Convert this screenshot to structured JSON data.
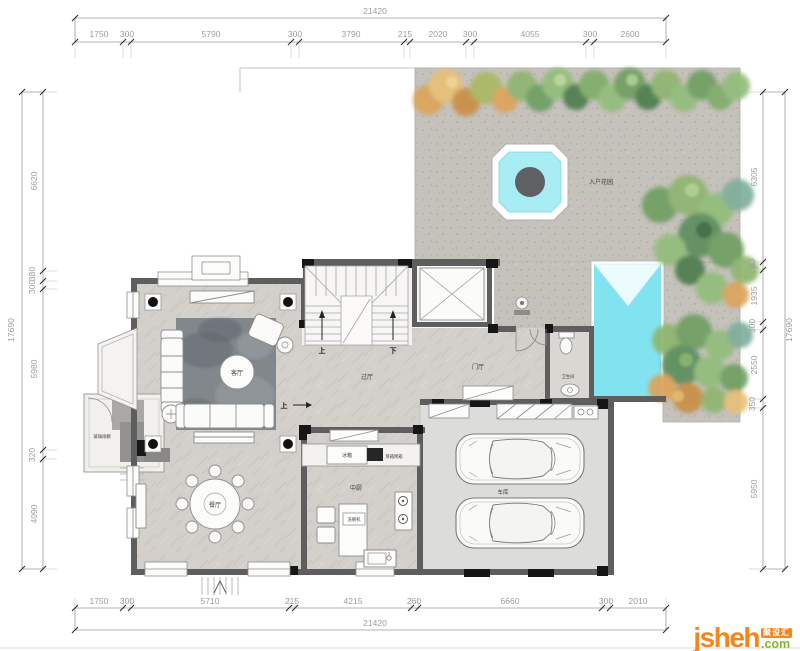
{
  "dims": {
    "top": {
      "total": "21420",
      "segments": [
        "1750",
        "300",
        "5790",
        "300",
        "3790",
        "215",
        "2020",
        "300",
        "4055",
        "300",
        "2600"
      ]
    },
    "bottom": {
      "total": "21420",
      "segments": [
        "1750",
        "300",
        "5710",
        "215",
        "4215",
        "260",
        "6660",
        "300",
        "2010"
      ]
    },
    "left": {
      "total": "17690",
      "segments": [
        "6620",
        "380",
        "300",
        "5980",
        "320",
        "4090"
      ]
    },
    "right": {
      "total": "17690",
      "segments": [
        "6305",
        "300",
        "1935",
        "300",
        "2550",
        "350",
        "5950"
      ]
    }
  },
  "rooms": {
    "garden": "入户花园",
    "living": "客厅",
    "dining": "餐厅",
    "hall": "过厅",
    "foyer": "门厅",
    "kitchen": "中厨",
    "garage": "车库",
    "bath": "卫生间",
    "canopy": "玻璃雨棚"
  },
  "appliances": {
    "fridge": "冰箱",
    "oven": "蒸箱烤箱",
    "dishwasher": "洗碗机"
  },
  "stairs": {
    "up": "上",
    "down": "下",
    "entry_up": "上"
  },
  "logo": {
    "brand": "jsheh",
    "tld": ".com",
    "badge": "聚设汇"
  },
  "colors": {
    "water": "#82e3f0",
    "wall": "#5e5e5e",
    "paving": "#c5c1bb",
    "marble": "#d3cfca",
    "garage_floor": "#dcdcda",
    "logo_orange": "#f4861c",
    "logo_green": "#83b727"
  }
}
